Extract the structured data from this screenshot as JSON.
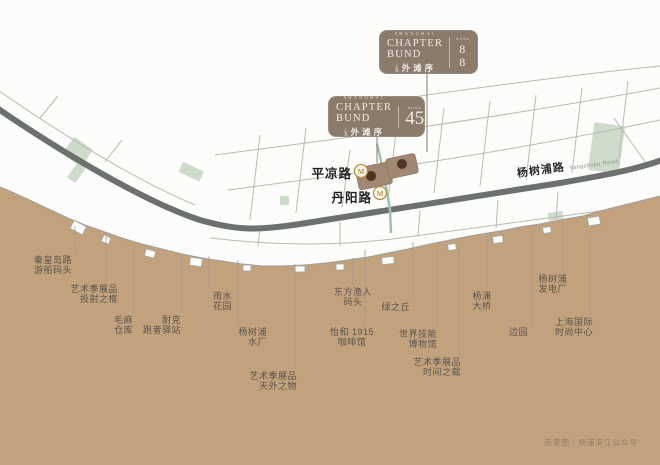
{
  "badges": [
    {
      "brand_top": "SHANGHAI",
      "brand_en": "CHAPTER BUND",
      "brand_cn_prefix": "上海",
      "brand_cn": "外滩序",
      "unit_label": "BUND",
      "unit_number": "88"
    },
    {
      "brand_top": "SHANGHAI",
      "brand_en": "CHAPTER BUND",
      "brand_cn_prefix": "上海",
      "brand_cn": "外滩序",
      "unit_label": "BUND",
      "unit_number": "45"
    }
  ],
  "map": {
    "road": {
      "name": "杨树浦路",
      "en": "Yangshupu Road"
    },
    "stations": [
      {
        "name": "平凉路"
      },
      {
        "name": "丹阳路"
      }
    ],
    "colors": {
      "badge_brown": "#8a7b6c",
      "parcel_brown": "#a18872",
      "parcel_dot": "#4e3526",
      "road_gray": "#6d716d",
      "park_green": "#cfdbca",
      "transit_teal": "#9cc2b4",
      "metro_gold": "#b5913f",
      "label_gray": "#5c554c"
    },
    "landmarks": [
      {
        "lines": [
          "秦皇岛路",
          "游船码头"
        ],
        "align": "center",
        "x": 53,
        "top": 256,
        "line": {
          "x": 75,
          "y1": 226,
          "y2": 253
        }
      },
      {
        "lines": [
          "艺术季展品",
          "投射之框"
        ],
        "align": "right",
        "x": 118,
        "top": 285,
        "line": {
          "x": 106,
          "y1": 236,
          "y2": 282
        }
      },
      {
        "lines": [
          "毛麻",
          "仓库"
        ],
        "align": "right",
        "x": 133,
        "top": 316,
        "line": {
          "x": 134,
          "y1": 246,
          "y2": 313
        }
      },
      {
        "lines": [
          "耐克",
          "跑者驿站"
        ],
        "align": "right",
        "x": 181,
        "top": 316,
        "line": {
          "x": 182,
          "y1": 254,
          "y2": 313
        }
      },
      {
        "lines": [
          "雨水",
          "花园"
        ],
        "align": "left",
        "x": 213,
        "top": 292,
        "line": {
          "x": 209,
          "y1": 256,
          "y2": 289
        }
      },
      {
        "lines": [
          "杨树浦",
          "水厂"
        ],
        "align": "right",
        "x": 267,
        "top": 328,
        "line": {
          "x": 238,
          "y1": 260,
          "y2": 325
        }
      },
      {
        "lines": [
          "艺术季展品",
          "天外之物"
        ],
        "align": "right",
        "x": 297,
        "top": 372,
        "line": {
          "x": 295,
          "y1": 264,
          "y2": 369
        }
      },
      {
        "lines": [
          "东方渔人",
          "码头"
        ],
        "align": "center",
        "x": 353,
        "top": 288,
        "line": {
          "x": 353,
          "y1": 258,
          "y2": 285
        }
      },
      {
        "lines": [
          "怡和 1915",
          "咖啡馆"
        ],
        "align": "center",
        "x": 352,
        "top": 328,
        "line": {
          "x": 365,
          "y1": 250,
          "y2": 325
        }
      },
      {
        "lines": [
          "绿之丘"
        ],
        "align": "right",
        "x": 410,
        "top": 303,
        "line": {
          "x": 413,
          "y1": 242,
          "y2": 300
        }
      },
      {
        "lines": [
          "世界技能",
          "博物馆"
        ],
        "align": "right",
        "x": 437,
        "top": 330,
        "line": {
          "x": 437,
          "y1": 248,
          "y2": 327
        }
      },
      {
        "lines": [
          "艺术季展品",
          "时间之载"
        ],
        "align": "right",
        "x": 461,
        "top": 358,
        "line": {
          "x": 459,
          "y1": 246,
          "y2": 355
        }
      },
      {
        "lines": [
          "杨浦",
          "大桥"
        ],
        "align": "center",
        "x": 482,
        "top": 292,
        "line": {
          "x": 487,
          "y1": 234,
          "y2": 289
        }
      },
      {
        "lines": [
          "边园"
        ],
        "align": "right",
        "x": 528,
        "top": 328,
        "line": {
          "x": 532,
          "y1": 230,
          "y2": 325
        }
      },
      {
        "lines": [
          "杨树浦",
          "发电厂"
        ],
        "align": "right",
        "x": 567,
        "top": 275,
        "line": {
          "x": 563,
          "y1": 222,
          "y2": 272
        }
      },
      {
        "lines": [
          "上海国际",
          "时尚中心"
        ],
        "align": "right",
        "x": 593,
        "top": 318,
        "line": {
          "x": 590,
          "y1": 236,
          "y2": 315
        }
      }
    ]
  },
  "caption": "示意图｜杨浦滨江公众号"
}
